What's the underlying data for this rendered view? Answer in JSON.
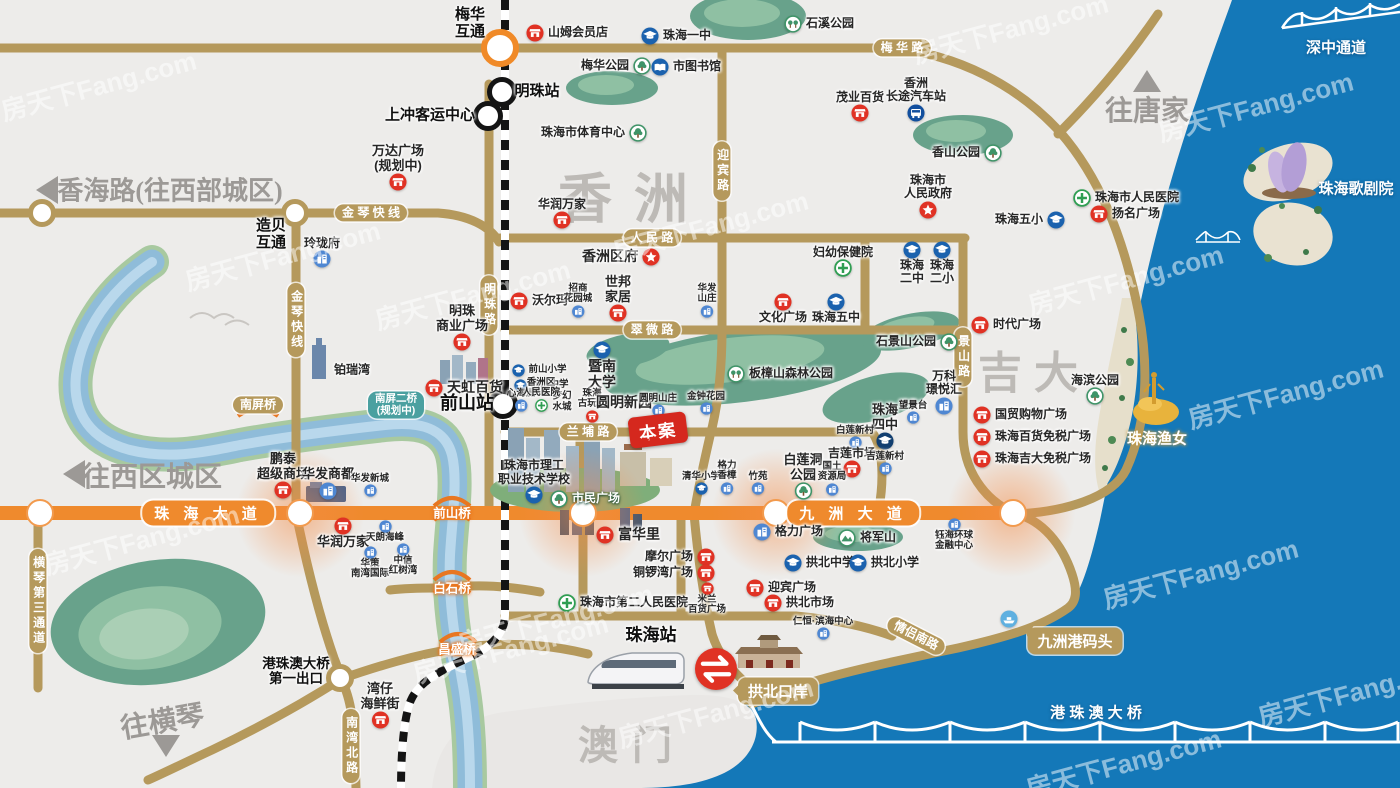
{
  "meta": {
    "width": 1400,
    "height": 788,
    "badge": "本案"
  },
  "colors": {
    "sea": "#1478b8",
    "land": "#edecea",
    "gold_road": "#b5995c",
    "highway": "#ef8a2d",
    "park": "#68a28b",
    "shop": "#e03224",
    "school": "#1b62ae",
    "estate": "#4f87d2",
    "hospital": "#2f9e52",
    "plan": "#4aa0a0",
    "rail_dark": "#141414"
  },
  "watermark": {
    "text": "房天下Fang.com",
    "positions": [
      [
        88,
        82
      ],
      [
        272,
        252
      ],
      [
        462,
        291
      ],
      [
        700,
        222
      ],
      [
        1000,
        25
      ],
      [
        1245,
        103
      ],
      [
        1115,
        276
      ],
      [
        1275,
        390
      ],
      [
        131,
        536
      ],
      [
        500,
        645
      ],
      [
        705,
        709
      ],
      [
        1190,
        570
      ],
      [
        1345,
        688
      ],
      [
        1113,
        760
      ],
      [
        545,
        615
      ]
    ]
  },
  "districts": [
    {
      "l": "香洲",
      "x": 634,
      "y": 194,
      "fs": 54,
      "ls": 22
    },
    {
      "l": "吉大",
      "x": 1034,
      "y": 369,
      "fs": 44,
      "ls": 12
    },
    {
      "l": "澳门",
      "x": 632,
      "y": 742,
      "fs": 40,
      "ls": 14
    }
  ],
  "directions": [
    {
      "l": "往唐家",
      "x": 1147,
      "y": 109,
      "fs": 28,
      "arrow": "up",
      "ax": 1147,
      "ay": 84,
      "rot": 0
    },
    {
      "l": "香海路(往西部城区)",
      "x": 170,
      "y": 189,
      "fs": 26,
      "arrow": "left",
      "ax": 50,
      "ay": 190,
      "rot": 0
    },
    {
      "l": "往西区城区",
      "x": 152,
      "y": 475,
      "fs": 28,
      "arrow": "left",
      "ax": 77,
      "ay": 474,
      "rot": 0
    },
    {
      "l": "往横琴",
      "x": 162,
      "y": 720,
      "fs": 28,
      "arrow": "down",
      "ax": 166,
      "ay": 749,
      "rot": -10
    }
  ],
  "road_pills": [
    {
      "l": "梅 华 路",
      "x": 902,
      "y": 48
    },
    {
      "l": "金 琴 快 线",
      "x": 371,
      "y": 213
    },
    {
      "l": "金琴快线",
      "x": 296,
      "y": 320,
      "v": 1
    },
    {
      "l": "人 民 路",
      "x": 652,
      "y": 238
    },
    {
      "l": "翠 微 路",
      "x": 652,
      "y": 330
    },
    {
      "l": "明珠路",
      "x": 489,
      "y": 305,
      "v": 1
    },
    {
      "l": "迎宾路",
      "x": 722,
      "y": 171,
      "v": 1
    },
    {
      "l": "景山路",
      "x": 963,
      "y": 357,
      "v": 1
    },
    {
      "l": "兰 埔 路",
      "x": 588,
      "y": 432
    },
    {
      "l": "南湾北路",
      "x": 351,
      "y": 746,
      "v": 1
    },
    {
      "l": "横琴第三通道",
      "x": 38,
      "y": 601,
      "v": 1
    },
    {
      "l": "情侣南路",
      "x": 916,
      "y": 636,
      "rot": 27
    },
    {
      "l": "南屏桥",
      "x": 258,
      "y": 405
    }
  ],
  "plan_pill": {
    "l": "南屏二桥\n(规划中)",
    "x": 396,
    "y": 405
  },
  "hw_labels": [
    {
      "l": "珠 海 大 道",
      "x": 208,
      "y": 513
    },
    {
      "l": "九 洲 大 道",
      "x": 853,
      "y": 513
    }
  ],
  "bridge_labels": [
    {
      "l": "前山桥",
      "x": 452,
      "y": 512
    },
    {
      "l": "白石桥",
      "x": 452,
      "y": 587
    },
    {
      "l": "昌盛桥",
      "x": 457,
      "y": 648
    }
  ],
  "bold_labels": [
    {
      "l": "梅华\n互通",
      "x": 470,
      "y": 24,
      "fs": 15
    },
    {
      "l": "明珠站",
      "x": 537,
      "y": 92,
      "fs": 15
    },
    {
      "l": "上冲客运中心",
      "x": 430,
      "y": 116,
      "fs": 15
    },
    {
      "l": "前山站",
      "x": 467,
      "y": 403,
      "fs": 18
    },
    {
      "l": "珠海站",
      "x": 651,
      "y": 635,
      "fs": 17
    },
    {
      "l": "造贝\n互通",
      "x": 271,
      "y": 235,
      "fs": 15
    },
    {
      "l": "港珠澳大桥\n第一出口",
      "x": 296,
      "y": 671,
      "fs": 13.5
    }
  ],
  "sea_labels": [
    {
      "l": "深中通道",
      "x": 1336,
      "y": 47,
      "fs": 15
    },
    {
      "l": "珠海歌剧院",
      "x": 1356,
      "y": 188,
      "fs": 15
    },
    {
      "l": "珠海渔女",
      "x": 1157,
      "y": 438,
      "fs": 15,
      "gold": 1
    },
    {
      "l": "港 珠 澳 大 桥",
      "x": 1096,
      "y": 712,
      "fs": 15
    }
  ],
  "callouts": [
    {
      "l": "拱北口岸",
      "x": 778,
      "y": 691,
      "tail": "left"
    },
    {
      "l": "九洲港码头",
      "x": 1075,
      "y": 641,
      "tail": "leftup"
    }
  ],
  "junctions": [
    {
      "t": "roundabout",
      "x": 500,
      "y": 48
    },
    {
      "t": "station",
      "x": 502,
      "y": 92
    },
    {
      "t": "station",
      "x": 488,
      "y": 116
    },
    {
      "t": "station",
      "x": 503,
      "y": 404
    },
    {
      "t": "gold",
      "x": 295,
      "y": 213
    },
    {
      "t": "gold",
      "x": 42,
      "y": 213
    },
    {
      "t": "gold",
      "x": 340,
      "y": 678
    },
    {
      "t": "hw",
      "x": 40,
      "y": 513
    },
    {
      "t": "hw",
      "x": 300,
      "y": 513
    },
    {
      "t": "hw",
      "x": 583,
      "y": 513
    },
    {
      "t": "hw",
      "x": 776,
      "y": 513
    },
    {
      "t": "hw",
      "x": 1013,
      "y": 513
    }
  ],
  "glows": [
    [
      300,
      513
    ],
    [
      583,
      513
    ],
    [
      776,
      513
    ],
    [
      1011,
      513
    ]
  ],
  "crossing": {
    "x": 716,
    "y": 669
  },
  "pois": [
    {
      "t": "shop",
      "l": "山姆会员店",
      "x": 535,
      "y": 33,
      "d": "right"
    },
    {
      "t": "school",
      "l": "珠海一中",
      "x": 650,
      "y": 36,
      "d": "right"
    },
    {
      "t": "park2",
      "l": "石溪公园",
      "x": 793,
      "y": 24,
      "d": "right"
    },
    {
      "t": "park",
      "l": "梅华公园",
      "x": 642,
      "y": 66,
      "d": "left"
    },
    {
      "t": "book",
      "l": "市图书馆",
      "x": 660,
      "y": 67,
      "d": "right"
    },
    {
      "t": "park",
      "l": "珠海市体育中心",
      "x": 638,
      "y": 133,
      "d": "left"
    },
    {
      "t": "shop",
      "l": "茂业百货",
      "x": 860,
      "y": 117,
      "d": "top"
    },
    {
      "t": "bus",
      "l": "香洲\n长途汽车站",
      "x": 916,
      "y": 117,
      "d": "top"
    },
    {
      "t": "park",
      "l": "香山公园",
      "x": 993,
      "y": 153,
      "d": "left"
    },
    {
      "t": "gov",
      "l": "珠海市\n人民政府",
      "x": 928,
      "y": 214,
      "d": "top"
    },
    {
      "t": "hosp",
      "l": "珠海市人民医院",
      "x": 1082,
      "y": 198,
      "d": "right"
    },
    {
      "t": "school",
      "l": "珠海五小",
      "x": 1056,
      "y": 220,
      "d": "left"
    },
    {
      "t": "shop",
      "l": "扬名广场",
      "x": 1099,
      "y": 214,
      "d": "right"
    },
    {
      "t": "hosp",
      "l": "妇幼保健院",
      "x": 843,
      "y": 272,
      "d": "top"
    },
    {
      "t": "school",
      "l": "珠海\n二中",
      "x": 912,
      "y": 250,
      "d": "bottom"
    },
    {
      "t": "school",
      "l": "珠海\n二小",
      "x": 942,
      "y": 250,
      "d": "bottom"
    },
    {
      "t": "shop",
      "l": "文化广场",
      "x": 783,
      "y": 302,
      "d": "bottom"
    },
    {
      "t": "school",
      "l": "珠海五中",
      "x": 836,
      "y": 302,
      "d": "bottom"
    },
    {
      "t": "park",
      "l": "石景山公园",
      "x": 949,
      "y": 342,
      "d": "left"
    },
    {
      "t": "shop",
      "l": "时代广场",
      "x": 980,
      "y": 325,
      "d": "right"
    },
    {
      "t": "park2",
      "l": "板樟山森林公园",
      "x": 736,
      "y": 374,
      "d": "right"
    },
    {
      "t": "park",
      "l": "海滨公园",
      "x": 1095,
      "y": 400,
      "d": "top"
    },
    {
      "t": "estate",
      "l": "万科\n璟悦汇",
      "x": 944,
      "y": 410,
      "d": "top"
    },
    {
      "t": "estate",
      "l": "望景台",
      "x": 913,
      "y": 421,
      "d": "top",
      "s": 1
    },
    {
      "t": "shop",
      "l": "国贸购物广场",
      "x": 982,
      "y": 415,
      "d": "right"
    },
    {
      "t": "shop",
      "l": "珠海百货免税广场",
      "x": 982,
      "y": 437,
      "d": "right"
    },
    {
      "t": "shop",
      "l": "珠海吉大免税广场",
      "x": 982,
      "y": 459,
      "d": "right"
    },
    {
      "t": "school2",
      "l": "珠海\n四中",
      "x": 885,
      "y": 445,
      "d": "top",
      "fs": 13
    },
    {
      "t": "estate",
      "l": "白莲新村",
      "x": 855,
      "y": 446,
      "d": "top",
      "s": 1
    },
    {
      "t": "shop",
      "l": "吉莲市场",
      "x": 852,
      "y": 473,
      "d": "top"
    },
    {
      "t": "estate",
      "l": "吉莲新村",
      "x": 885,
      "y": 472,
      "d": "top",
      "s": 1
    },
    {
      "t": "park",
      "l": "白莲洞\n公园",
      "x": 803,
      "y": 495,
      "d": "top",
      "fs": 13
    },
    {
      "t": "estate",
      "l": "国土\n资源局",
      "x": 832,
      "y": 493,
      "d": "top",
      "s": 1
    },
    {
      "t": "estate",
      "l": "格力广场",
      "x": 762,
      "y": 532,
      "d": "right"
    },
    {
      "t": "mount",
      "l": "将军山",
      "x": 847,
      "y": 538,
      "d": "right"
    },
    {
      "t": "school",
      "l": "拱北中学",
      "x": 793,
      "y": 563,
      "d": "right"
    },
    {
      "t": "school",
      "l": "拱北小学",
      "x": 858,
      "y": 563,
      "d": "right"
    },
    {
      "t": "shop",
      "l": "迎宾广场",
      "x": 755,
      "y": 588,
      "d": "right"
    },
    {
      "t": "shop",
      "l": "拱北市场",
      "x": 773,
      "y": 603,
      "d": "right"
    },
    {
      "t": "hosp",
      "l": "珠海市第二人民医院",
      "x": 567,
      "y": 603,
      "d": "right"
    },
    {
      "t": "shop",
      "l": "摩尔广场",
      "x": 706,
      "y": 557,
      "d": "left"
    },
    {
      "t": "shop",
      "l": "铜锣湾广场",
      "x": 706,
      "y": 573,
      "d": "left"
    },
    {
      "t": "shop",
      "l": "米兰\n百货广场",
      "x": 707,
      "y": 588,
      "d": "bottom",
      "s": 1
    },
    {
      "t": "shop",
      "l": "富华里",
      "x": 605,
      "y": 535,
      "d": "right",
      "b": 1
    },
    {
      "t": "estate",
      "l": "仁恒·滨海中心",
      "x": 823,
      "y": 637,
      "d": "top",
      "s": 1
    },
    {
      "t": "estate",
      "l": "钰海环球\n金融中心",
      "x": 954,
      "y": 524,
      "d": "bottom",
      "s": 1
    },
    {
      "t": "shop",
      "l": "湾仔\n海鲜街",
      "x": 380,
      "y": 724,
      "d": "top",
      "fs": 13
    },
    {
      "t": "shop",
      "l": "鹏泰\n超级商场",
      "x": 283,
      "y": 494,
      "d": "top",
      "fs": 13
    },
    {
      "t": "estate",
      "l": "华发商都",
      "x": 328,
      "y": 494,
      "d": "top",
      "fs": 13
    },
    {
      "t": "estate",
      "l": "华发新城",
      "x": 370,
      "y": 494,
      "d": "top",
      "s": 1
    },
    {
      "t": "shop",
      "l": "华润万家",
      "x": 343,
      "y": 526,
      "d": "bottom",
      "fs": 13
    },
    {
      "t": "estate",
      "l": "天朗海峰",
      "x": 385,
      "y": 526,
      "d": "bottom",
      "s": 1
    },
    {
      "t": "estate",
      "l": "华策\n南湾国际",
      "x": 370,
      "y": 552,
      "d": "bottom",
      "s": 1
    },
    {
      "t": "estate",
      "l": "中信\n红树湾",
      "x": 403,
      "y": 549,
      "d": "bottom",
      "s": 1
    },
    {
      "t": "estate",
      "l": "玲珑府",
      "x": 322,
      "y": 263,
      "d": "top"
    },
    {
      "t": "none",
      "l": "铂瑞湾",
      "x": 352,
      "y": 370,
      "d": "center"
    },
    {
      "t": "shop",
      "l": "万达广场\n(规划中)",
      "x": 398,
      "y": 186,
      "d": "top",
      "fs": 13
    },
    {
      "t": "shop",
      "l": "明珠\n商业广场",
      "x": 462,
      "y": 346,
      "d": "top",
      "fs": 13
    },
    {
      "t": "shop",
      "l": "天虹百货",
      "x": 434,
      "y": 388,
      "d": "right",
      "b": 1
    },
    {
      "t": "shop",
      "l": "沃尔玛",
      "x": 519,
      "y": 301,
      "d": "right"
    },
    {
      "t": "estate",
      "l": "招商\n花园城",
      "x": 578,
      "y": 315,
      "d": "top",
      "s": 1
    },
    {
      "t": "shop",
      "l": "世邦\n家居",
      "x": 618,
      "y": 317,
      "d": "top",
      "fs": 13
    },
    {
      "t": "estate",
      "l": "华发\n山庄",
      "x": 707,
      "y": 315,
      "d": "top",
      "s": 1
    },
    {
      "t": "shop",
      "l": "华润万家",
      "x": 562,
      "y": 224,
      "d": "top"
    },
    {
      "t": "school",
      "l": "前山小学",
      "x": 518,
      "y": 370,
      "d": "right",
      "s": 1
    },
    {
      "t": "school",
      "l": "前山中学",
      "x": 520,
      "y": 385,
      "d": "right",
      "s": 1
    },
    {
      "t": "school",
      "l": "暨南\n大学",
      "x": 602,
      "y": 350,
      "d": "bottom",
      "fs": 14
    },
    {
      "t": "none",
      "l": "梦幻\n水城",
      "x": 562,
      "y": 402,
      "d": "center",
      "s": 1
    },
    {
      "t": "shop",
      "l": "珠海\n古玩城",
      "x": 592,
      "y": 420,
      "d": "top",
      "s": 1
    },
    {
      "t": "none",
      "l": "圆明新园",
      "x": 624,
      "y": 403,
      "d": "center",
      "b": 1
    },
    {
      "t": "estate",
      "l": "圆明山庄",
      "x": 658,
      "y": 414,
      "d": "top",
      "s": 1
    },
    {
      "t": "estate",
      "l": "金钟花园",
      "x": 706,
      "y": 412,
      "d": "top",
      "s": 1
    },
    {
      "t": "school",
      "l": "珠海市理工\n职业技术学校",
      "x": 534,
      "y": 499,
      "d": "top",
      "fs": 12
    },
    {
      "t": "park",
      "l": "市民广场",
      "x": 559,
      "y": 499,
      "d": "right",
      "w": 1
    },
    {
      "t": "estate",
      "l": "心海洲",
      "x": 521,
      "y": 409,
      "d": "top",
      "s": 1
    },
    {
      "t": "hosp",
      "l": "香洲区\n人民医院",
      "x": 541,
      "y": 409,
      "d": "top",
      "s": 1
    },
    {
      "t": "school",
      "l": "清华小学",
      "x": 701,
      "y": 492,
      "d": "top",
      "s": 1
    },
    {
      "t": "estate",
      "l": "格力\n香樟",
      "x": 727,
      "y": 492,
      "d": "top",
      "s": 1
    },
    {
      "t": "estate",
      "l": "竹苑",
      "x": 758,
      "y": 492,
      "d": "top",
      "s": 1
    },
    {
      "t": "gov",
      "l": "香洲区府",
      "x": 651,
      "y": 257,
      "d": "left",
      "fs": 14
    },
    {
      "t": "ferry",
      "l": "",
      "x": 1009,
      "y": 619,
      "d": "center"
    }
  ]
}
